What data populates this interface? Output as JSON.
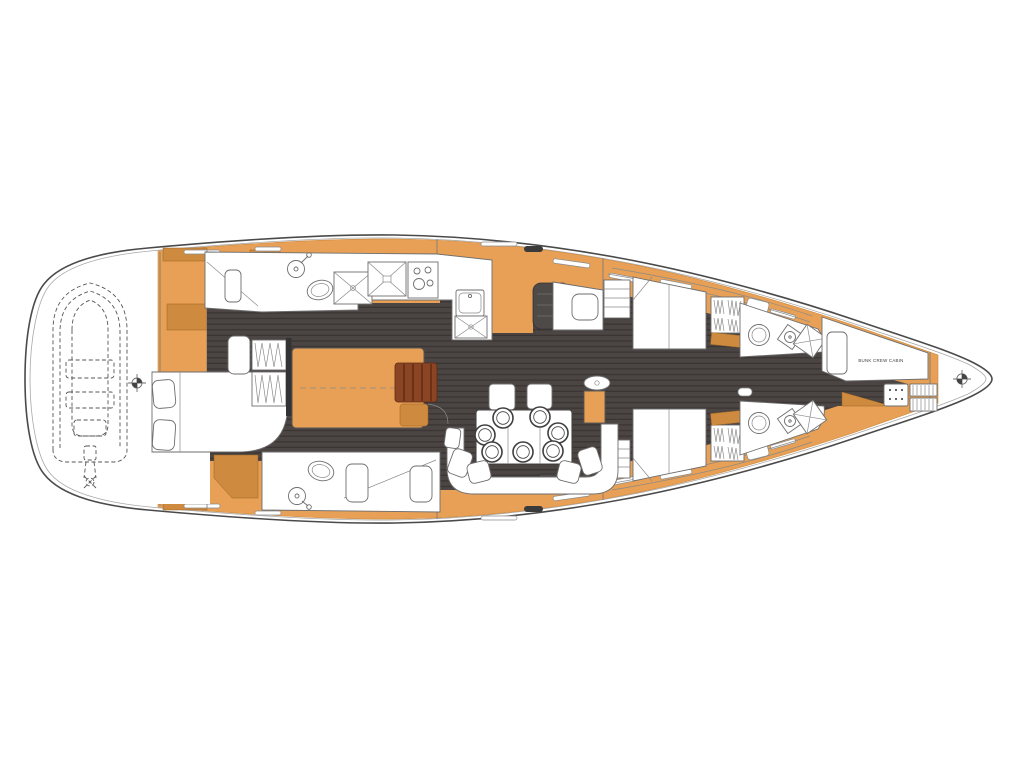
{
  "diagram": {
    "labels": {
      "bunk_crew_cabin": "BUNK CREW CABIN"
    },
    "colors": {
      "background": "#FFFFFF",
      "hull_line": "#4A4A4A",
      "inner_line": "#A9A9A9",
      "deck_orange": "#E7A055",
      "deck_orange_dark": "#CE8A3E",
      "wood_dark": "#8B4525",
      "wood_dark_edge": "#5E2B12",
      "floor_dark": "#4B4543",
      "floor_stripe": "#3A3533",
      "hatch_dark": "#4E4A48",
      "furniture_line": "#6E6E6E",
      "detail_line": "#8A8A8A"
    }
  }
}
